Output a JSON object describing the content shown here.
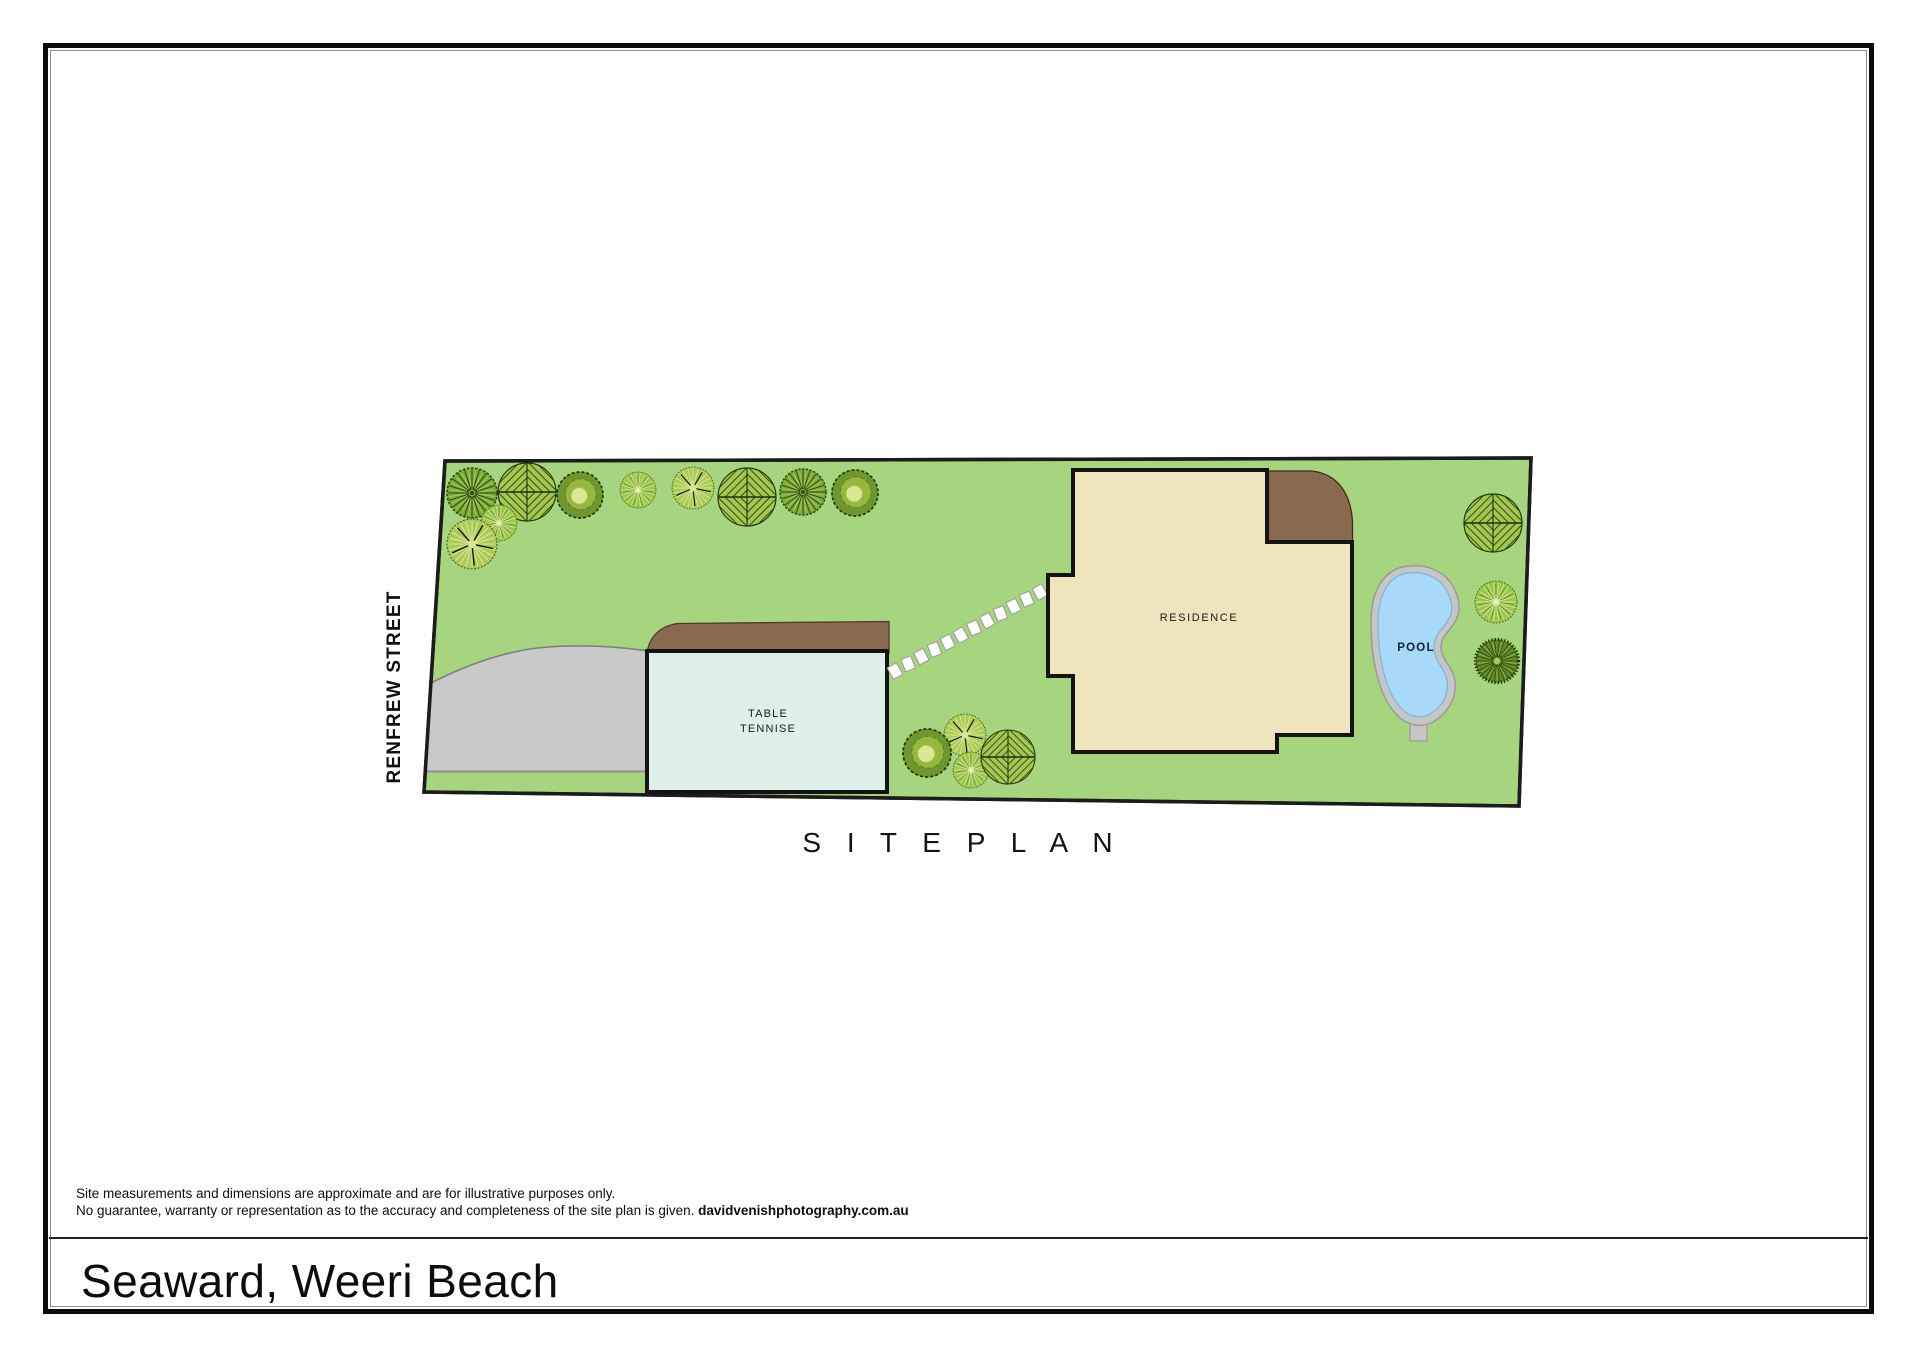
{
  "page": {
    "title": "Seaward, Weeri Beach",
    "disclaimer_line1": "Site measurements and dimensions are approximate and are for illustrative purposes only.",
    "disclaimer_line2": "No guarantee, warranty or representation as to the accuracy and completeness of the site plan is given.",
    "disclaimer_credit": "davidvenishphotography.com.au"
  },
  "plan": {
    "title": "S I T E   P L A N",
    "street_label": "RENFREW STREET",
    "labels": {
      "residence": "RESIDENCE",
      "pool": "POOL",
      "table_tennis_line1": "TABLE",
      "table_tennis_line2": "TENNISE"
    },
    "colors": {
      "grass": "#a7d47f",
      "boundary": "#1c1c1c",
      "driveway": "#c9c9c9",
      "building": "#dff0eb",
      "residence": "#efe4be",
      "deck": "#8a6a4e",
      "pool_water": "#a9d9f8",
      "pool_rim": "#c6c6c6"
    },
    "trees": [
      {
        "type": "starburst",
        "x": 472,
        "y": 493,
        "r": 25
      },
      {
        "type": "chevron",
        "x": 527,
        "y": 492,
        "r": 29
      },
      {
        "type": "blob",
        "x": 580,
        "y": 495,
        "r": 23
      },
      {
        "type": "starlight",
        "x": 638,
        "y": 490,
        "r": 18
      },
      {
        "type": "palm",
        "x": 693,
        "y": 488,
        "r": 21
      },
      {
        "type": "chevron",
        "x": 747,
        "y": 497,
        "r": 29
      },
      {
        "type": "starburst",
        "x": 803,
        "y": 492,
        "r": 23
      },
      {
        "type": "blob",
        "x": 855,
        "y": 493,
        "r": 23
      },
      {
        "type": "starlight",
        "x": 499,
        "y": 523,
        "r": 18
      },
      {
        "type": "palm",
        "x": 472,
        "y": 544,
        "r": 25
      },
      {
        "type": "palm",
        "x": 965,
        "y": 735,
        "r": 21
      },
      {
        "type": "blob",
        "x": 927,
        "y": 753,
        "r": 24
      },
      {
        "type": "starlight",
        "x": 971,
        "y": 770,
        "r": 18
      },
      {
        "type": "chevron",
        "x": 1008,
        "y": 757,
        "r": 27
      },
      {
        "type": "chevron",
        "x": 1493,
        "y": 523,
        "r": 29
      },
      {
        "type": "starlight",
        "x": 1496,
        "y": 602,
        "r": 21
      },
      {
        "type": "spiky",
        "x": 1497,
        "y": 661,
        "r": 24
      }
    ],
    "stepping_stones": {
      "from": [
        895,
        671
      ],
      "to": [
        1040,
        592
      ],
      "count": 12,
      "stone_w": 10.5,
      "stone_h": 13
    }
  }
}
